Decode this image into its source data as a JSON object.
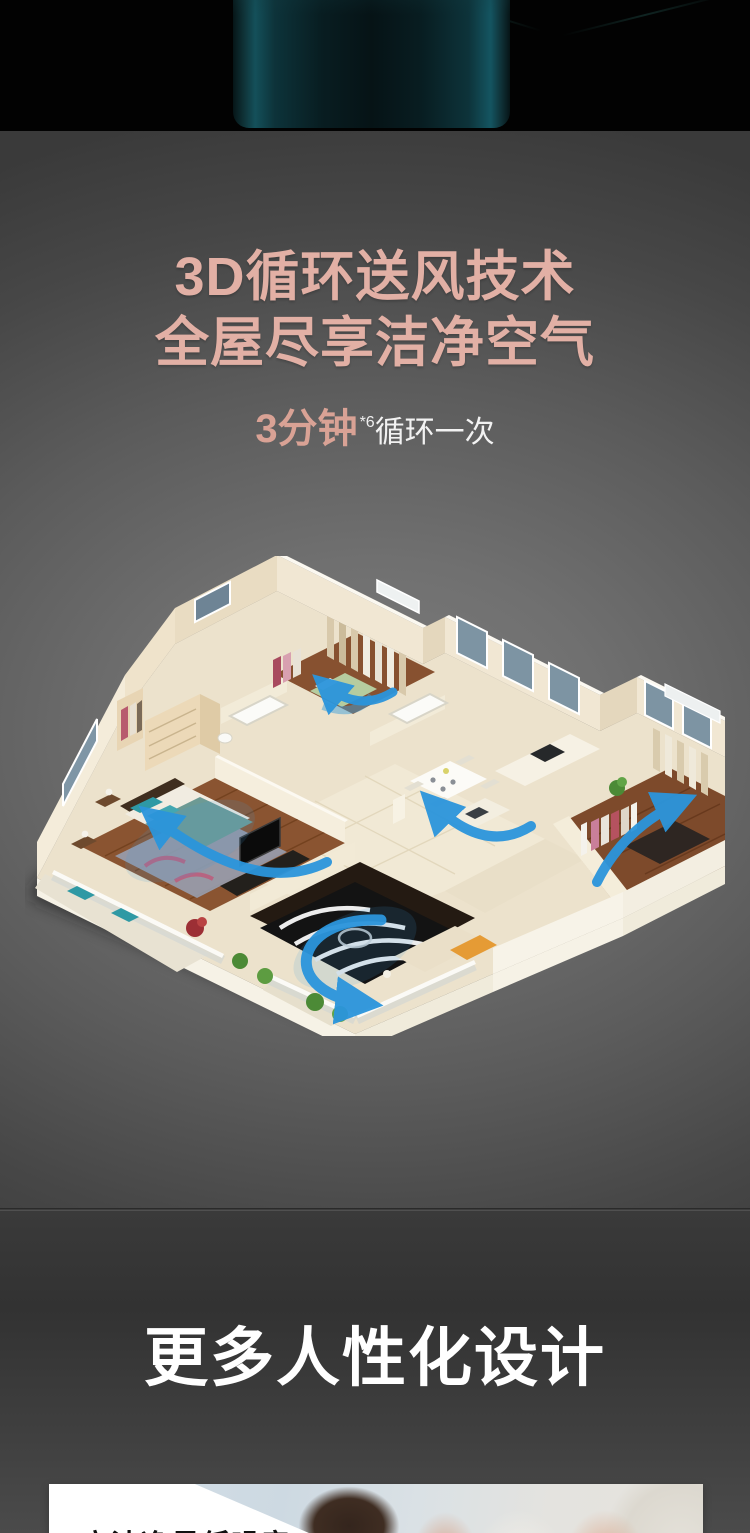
{
  "colors": {
    "accent_title": "#e2b0a5",
    "airflow_arrow_blue": "#2b95dc",
    "product_body_teal": "#0d3138",
    "section_divider": "#5a5a5a"
  },
  "icons": {
    "airflow_arrow": "curved-blue-arrow"
  },
  "airflow_section": {
    "title_line1": "3D循环送风技术",
    "title_line2": "全屋尽享洁净空气",
    "stat_value": "3分钟",
    "stat_footnote": "*6",
    "stat_suffix": "循环一次"
  },
  "design_section": {
    "title": "更多人性化设计"
  },
  "noise_card": {
    "title": "高洁净量低噪音"
  }
}
